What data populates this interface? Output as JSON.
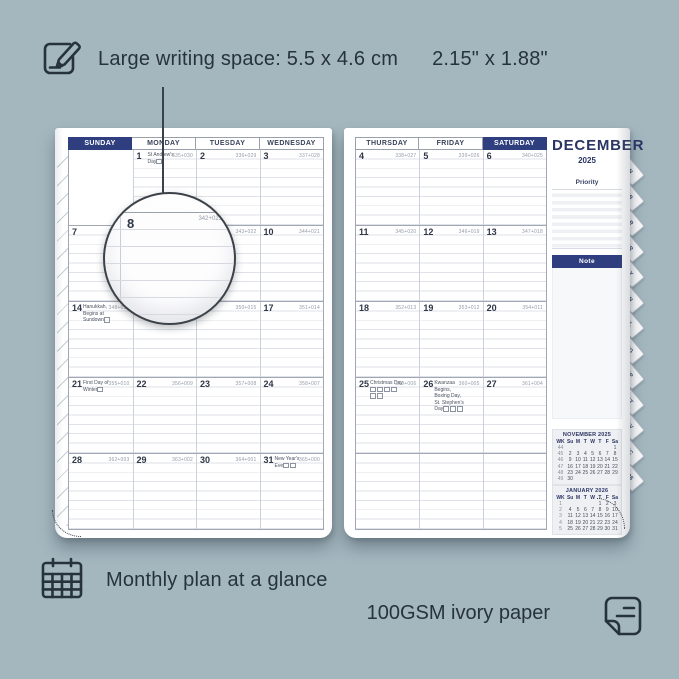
{
  "colors": {
    "accent_navy": "#2e3e7e",
    "background": "#a4b7bf",
    "page": "#ffffff"
  },
  "icons": {
    "writing": "pencil-note-icon",
    "monthly": "calendar-grid-icon",
    "paper": "paper-sheet-icon"
  },
  "annotations": {
    "writing_space": "Large writing space: 5.5 x 4.6 cm",
    "writing_space_inches": "2.15\" x 1.88\"",
    "monthly_plan": "Monthly plan at a glance",
    "paper": "100GSM ivory paper"
  },
  "planner": {
    "month": "DECEMBER",
    "year": "2025",
    "left_day_headers": [
      {
        "label": "SUNDAY",
        "highlight": true
      },
      {
        "label": "MONDAY"
      },
      {
        "label": "TUESDAY"
      },
      {
        "label": "WEDNESDAY"
      }
    ],
    "right_day_headers": [
      {
        "label": "THURSDAY"
      },
      {
        "label": "FRIDAY"
      },
      {
        "label": "SATURDAY",
        "highlight": true
      }
    ],
    "left_weeks": [
      [
        {
          "empty": true
        },
        {
          "d": "1",
          "c": "335+030",
          "h": "St Andrew's Day",
          "f": 1
        },
        {
          "d": "2",
          "c": "336+029"
        },
        {
          "d": "3",
          "c": "337+028"
        }
      ],
      [
        {
          "d": "7",
          "c": "341+024"
        },
        {
          "d": "8",
          "c": "342+023"
        },
        {
          "d": "9",
          "c": "343+022"
        },
        {
          "d": "10",
          "c": "344+021"
        }
      ],
      [
        {
          "d": "14",
          "c": "348+017",
          "h": "Hanukkah, Begins at Sundown",
          "f": 1
        },
        {
          "d": "15",
          "c": "349+016"
        },
        {
          "d": "16",
          "c": "350+015"
        },
        {
          "d": "17",
          "c": "351+014"
        }
      ],
      [
        {
          "d": "21",
          "c": "355+010",
          "h": "First Day of Winter",
          "f": 1
        },
        {
          "d": "22",
          "c": "356+009"
        },
        {
          "d": "23",
          "c": "357+008"
        },
        {
          "d": "24",
          "c": "358+007"
        }
      ],
      [
        {
          "d": "28",
          "c": "362+003"
        },
        {
          "d": "29",
          "c": "363+002"
        },
        {
          "d": "30",
          "c": "364+001"
        },
        {
          "d": "31",
          "c": "365+000",
          "h": "New Year's Eve",
          "f": 2
        }
      ]
    ],
    "right_weeks": [
      [
        {
          "d": "4",
          "c": "338+027"
        },
        {
          "d": "5",
          "c": "339+026"
        },
        {
          "d": "6",
          "c": "340+025"
        }
      ],
      [
        {
          "d": "11",
          "c": "345+020"
        },
        {
          "d": "12",
          "c": "346+019"
        },
        {
          "d": "13",
          "c": "347+018"
        }
      ],
      [
        {
          "d": "18",
          "c": "352+013"
        },
        {
          "d": "19",
          "c": "353+012"
        },
        {
          "d": "20",
          "c": "354+011"
        }
      ],
      [
        {
          "d": "25",
          "c": "359+006",
          "h": "Christmas Day",
          "f": 6
        },
        {
          "d": "26",
          "c": "360+005",
          "h": "Kwanzaa Begins, Boxing Day, St. Stephen's Day",
          "f": 3
        },
        {
          "d": "27",
          "c": "361+004"
        }
      ],
      [
        {},
        {},
        {}
      ]
    ],
    "sidebar": {
      "priority_label": "Priority",
      "note_label": "Note",
      "tabs": [
        "JAN",
        "FEB",
        "MAR",
        "APR",
        "MAY",
        "JUN",
        "JUL",
        "AUG",
        "SEP",
        "OCT",
        "NOV",
        "DEC",
        "2026"
      ],
      "mini_calendars": [
        {
          "title": "NOVEMBER 2025",
          "header": [
            "WK",
            "Su",
            "M",
            "T",
            "W",
            "T",
            "F",
            "Sa"
          ],
          "rows": [
            [
              "44",
              "",
              "",
              "",
              "",
              "",
              "",
              "1"
            ],
            [
              "45",
              "2",
              "3",
              "4",
              "5",
              "6",
              "7",
              "8"
            ],
            [
              "46",
              "9",
              "10",
              "11",
              "12",
              "13",
              "14",
              "15"
            ],
            [
              "47",
              "16",
              "17",
              "18",
              "19",
              "20",
              "21",
              "22"
            ],
            [
              "48",
              "23",
              "24",
              "25",
              "26",
              "27",
              "28",
              "29"
            ],
            [
              "49",
              "30",
              "",
              "",
              "",
              "",
              "",
              ""
            ]
          ]
        },
        {
          "title": "JANUARY 2026",
          "header": [
            "WK",
            "Su",
            "M",
            "T",
            "W",
            "T",
            "F",
            "Sa"
          ],
          "rows": [
            [
              "1",
              "",
              "",
              "",
              "",
              "1",
              "2",
              "3"
            ],
            [
              "2",
              "4",
              "5",
              "6",
              "7",
              "8",
              "9",
              "10"
            ],
            [
              "3",
              "11",
              "12",
              "13",
              "14",
              "15",
              "16",
              "17"
            ],
            [
              "4",
              "18",
              "19",
              "20",
              "21",
              "22",
              "23",
              "24"
            ],
            [
              "5",
              "25",
              "26",
              "27",
              "28",
              "29",
              "30",
              "31"
            ]
          ]
        }
      ]
    },
    "magnifier": {
      "day": "8",
      "code": "342+023"
    }
  }
}
